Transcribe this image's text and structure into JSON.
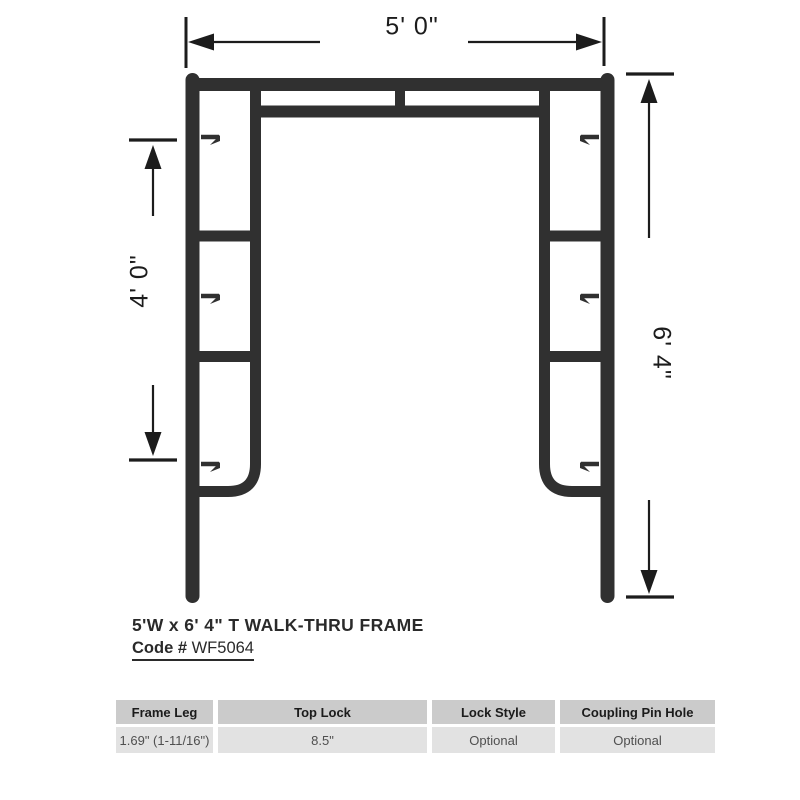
{
  "drawing": {
    "width_label": "5' 0\"",
    "left_height_label": "4' 0\"",
    "right_height_label": "6' 4\""
  },
  "title": {
    "product_name": "5'W x 6' 4\" T WALK-THRU FRAME",
    "code_label": "Code #",
    "code_value": "WF5064"
  },
  "spec_table": {
    "headers": [
      "Frame Leg",
      "Top Lock",
      "Lock Style",
      "Coupling Pin Hole"
    ],
    "values": [
      "1.69\" (1-11/16\")",
      "8.5\"",
      "Optional",
      "Optional"
    ]
  },
  "colors": {
    "background": "#ffffff",
    "frame": "#303030",
    "dimension_lines": "#1c1c1c",
    "table_header_bg": "#cbcbcb",
    "table_row_bg": "#e2e2e2",
    "table_header_text": "#1b1b1b",
    "table_row_text": "#4f4f4f"
  }
}
